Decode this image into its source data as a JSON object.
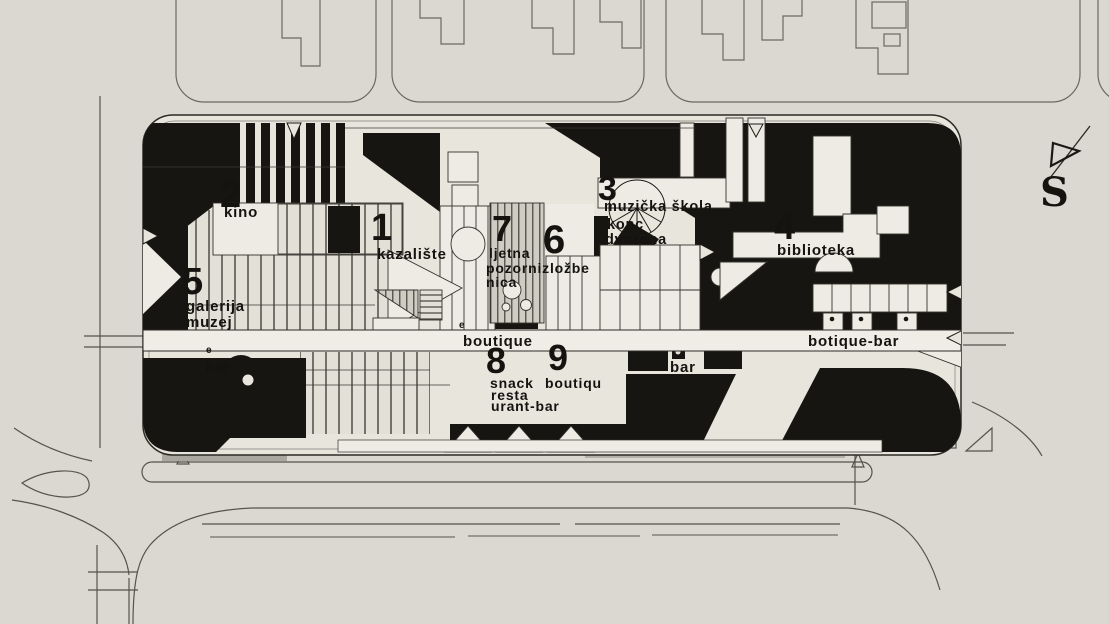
{
  "drawing": {
    "type": "architectural-site-plan",
    "compass": {
      "label": "S"
    },
    "colors": {
      "paper": "#dad8d0",
      "site_paper": "#e7e5dc",
      "white_shape": "#edebe4",
      "ink": "#171511",
      "context_line": "#6b6960"
    },
    "labels": {
      "n1_num": "1",
      "n1_text": "kazalište",
      "n2_num": "2",
      "n2_text": "kino",
      "n3_num": "3",
      "n3_l1": "muzička škola",
      "n3_l2": "konc",
      "n3_l3": "dvorana",
      "n4_num": "4",
      "n4_text": "biblioteka",
      "n5_num": "5",
      "n5_l1": "galerija",
      "n5_l2": "muzej",
      "n5_e": "e",
      "n5_bar": "bar",
      "n6_num": "6",
      "n7_num": "7",
      "n7_l1": "ljetna",
      "n7_l2": "pozornizložbe",
      "n7_l3": "nica",
      "n8_num": "8",
      "n8_l1": "snack",
      "n8_l2": "resta",
      "n8_l3": "urant-bar",
      "n9_num": "9",
      "n9_text": "boutiqu",
      "spine_left": "boutique",
      "spine_left_e": "e",
      "bar_center": "bar",
      "spine_right": "botique-bar",
      "compass_s": "S"
    }
  }
}
